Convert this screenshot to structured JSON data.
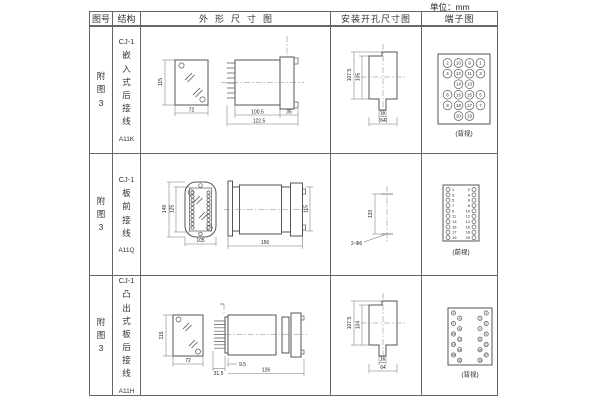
{
  "unit_label": "单位：mm",
  "header": {
    "col_fig": "图号",
    "col_structure": "结构",
    "col_outline": "外形尺寸图",
    "col_mounting": "安装开孔尺寸图",
    "col_terminal": "端子图"
  },
  "rows": [
    {
      "fig_no": "附图3",
      "model": "CJ-1",
      "structure_chars": "嵌入式后接线",
      "code": "A11K",
      "outline": {
        "front_height": "115",
        "front_width": "72",
        "depth": "100.5",
        "overall": "122.5",
        "flange": "35"
      },
      "mounting": {
        "outer": "107.5",
        "inner": "105",
        "notch": "16",
        "bottom": "(64)"
      },
      "terminal": {
        "caption": "(背视)",
        "grid": [
          [
            2,
            10,
            9,
            1
          ],
          [
            4,
            12,
            11,
            3
          ],
          [
            null,
            14,
            13,
            null
          ],
          [
            6,
            16,
            15,
            5
          ],
          [
            8,
            18,
            17,
            7
          ],
          [
            null,
            20,
            19,
            null
          ]
        ]
      }
    },
    {
      "fig_no": "附图3",
      "model": "CJ-1",
      "structure_chars": "板前接线",
      "code": "A11Q",
      "outline": {
        "outer_height": "149",
        "inner_height": "125",
        "width": "105",
        "depth": "156",
        "side_height": "115"
      },
      "mounting": {
        "spacing": "133",
        "holes": "2-Φ6"
      },
      "terminal": {
        "caption": "(前视)",
        "left_grid": [
          [
            1
          ],
          [
            3
          ],
          [
            5
          ],
          [
            7
          ],
          [
            9
          ],
          [
            11
          ],
          [
            13
          ],
          [
            15
          ],
          [
            17
          ],
          [
            19
          ]
        ],
        "right_grid": [
          [
            2
          ],
          [
            4
          ],
          [
            6
          ],
          [
            8
          ],
          [
            10
          ],
          [
            12
          ],
          [
            14
          ],
          [
            16
          ],
          [
            18
          ],
          [
            20
          ]
        ]
      }
    },
    {
      "fig_no": "附图3",
      "model": "CJ-1",
      "structure_chars": "凸出式板后接线",
      "code": "A11H",
      "outline": {
        "front_height": "115",
        "front_width": "72",
        "pin_len": "31.5",
        "offset": "9.5",
        "depth": "126"
      },
      "mounting": {
        "outer": "107.5",
        "inner": "104",
        "notch": "16",
        "bottom": "64"
      },
      "terminal": {
        "caption": "(背视)",
        "left_grid": [
          [
            2,
            null
          ],
          [
            null,
            4
          ],
          [
            6,
            null
          ],
          [
            null,
            8
          ],
          [
            10,
            null
          ],
          [
            null,
            12
          ],
          [
            14,
            null
          ],
          [
            null,
            16
          ],
          [
            18,
            null
          ],
          [
            null,
            20
          ]
        ],
        "right_grid": [
          [
            null,
            1
          ],
          [
            3,
            null
          ],
          [
            null,
            5
          ],
          [
            7,
            null
          ],
          [
            null,
            9
          ],
          [
            11,
            null
          ],
          [
            null,
            13
          ],
          [
            15,
            null
          ],
          [
            null,
            17
          ],
          [
            19,
            null
          ]
        ]
      }
    }
  ]
}
